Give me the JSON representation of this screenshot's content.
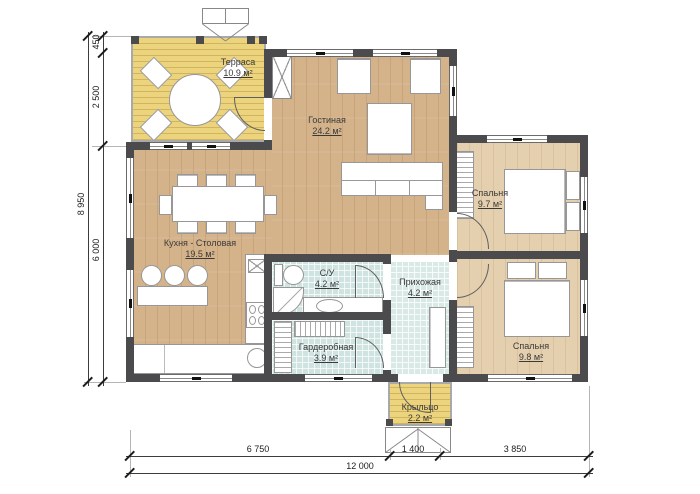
{
  "plan_title": "floor-plan",
  "rooms": {
    "terrace": {
      "name": "Терраса",
      "area": "10.9 м²"
    },
    "living": {
      "name": "Гостиная",
      "area": "24.2 м²"
    },
    "bedroom1": {
      "name": "Спальня",
      "area": "9.7 м²"
    },
    "kitchen": {
      "name": "Кухня - Столовая",
      "area": "19.5 м²"
    },
    "bathroom": {
      "name": "С/У",
      "area": "4.2 м²"
    },
    "hallway": {
      "name": "Прихожая",
      "area": "4.2 м²"
    },
    "wardrobe": {
      "name": "Гардеробная",
      "area": "3.9 м²"
    },
    "bedroom2": {
      "name": "Спальня",
      "area": "9.8 м²"
    },
    "porch": {
      "name": "Крыльцо",
      "area": "2.2 м²"
    }
  },
  "dimensions": {
    "left": {
      "seg1": "450",
      "seg2": "2 500",
      "seg3": "6 000",
      "total": "8 950"
    },
    "bottom": {
      "seg1": "6 750",
      "seg2": "1 400",
      "seg3": "3 850",
      "total": "12 000"
    }
  },
  "colors": {
    "wall": "#4b4b4e",
    "wood_main": "#d4b38b",
    "wood_bedroom": "#e4cfae",
    "deck": "#ecd37e",
    "tile": "#cfe3e0"
  }
}
